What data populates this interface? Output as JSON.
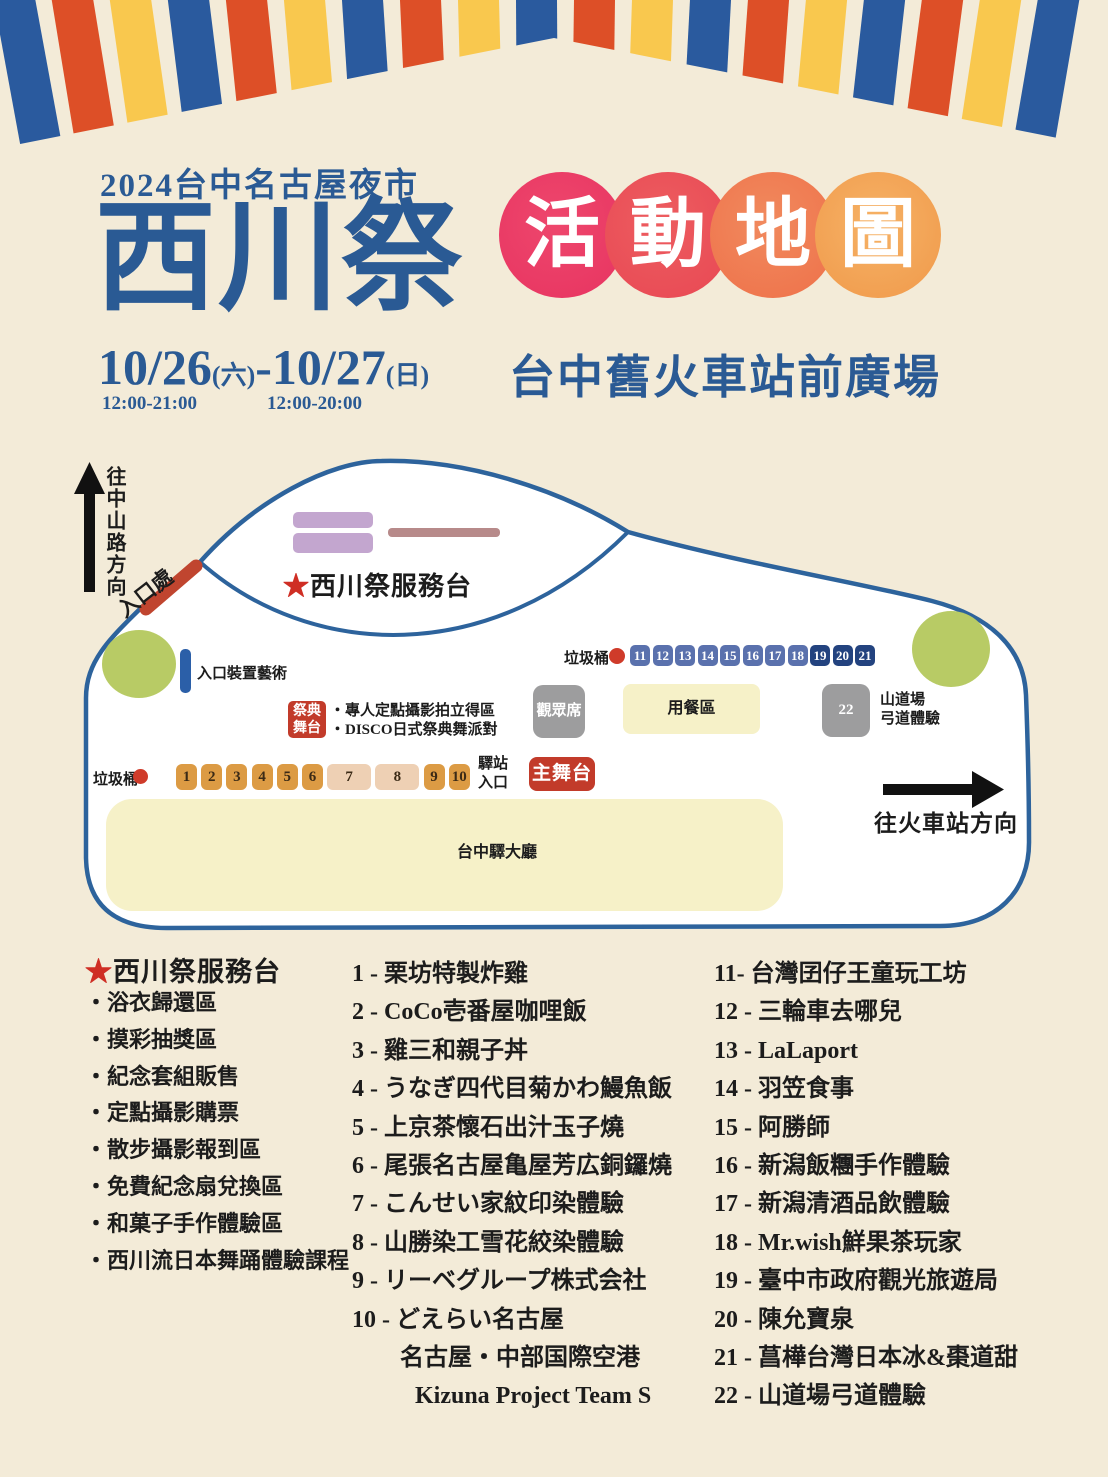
{
  "colors": {
    "background": "#f3ebd8",
    "title_blue": "#2a5a94",
    "stripe_blue": "#2a5a9e",
    "stripe_orange": "#dd4f27",
    "stripe_yellow": "#f9c84e",
    "circle_gradient": [
      "#e73360",
      "#e84753",
      "#ee7049",
      "#f0994a"
    ],
    "map_outline": "#2d639c",
    "accent_red": "#c23b2a",
    "entrance_red": "#c0452f",
    "booth_orange": "#dc9b44",
    "booth_tan": "#eed0b4",
    "booth_blue": "#5a71ad",
    "booth_navy": "#23437f",
    "area_gray": "#9d9d9e",
    "area_yellow": "#f6f1c8",
    "green_area": "#b8cb65",
    "purple_area": "#c3a6cf",
    "mauve_area": "#b78a8a",
    "art_bar_blue": "#2b5fa8"
  },
  "header": {
    "subtitle": "2024台中名古屋夜市",
    "title": "西川祭",
    "map_title_chars": [
      "活",
      "動",
      "地",
      "圖"
    ],
    "venue": "台中舊火車站前廣場",
    "date1": "10/26",
    "day1": "(六)",
    "separator": "-",
    "date2": "10/27",
    "day2": "(日)",
    "time1": "12:00-21:00",
    "time2": "12:00-20:00"
  },
  "map": {
    "to_zhongshan": "往中山路方向",
    "entrance": "入口處",
    "service_desk_star": "★",
    "service_desk": "西川祭服務台",
    "entrance_art": "入口裝置藝術",
    "trash_top": "垃圾桶",
    "trash_bottom": "垃圾桶",
    "audience": "觀眾席",
    "dining": "用餐區",
    "booth22": "22",
    "archery_line1": "山道場",
    "archery_line2": "弓道體驗",
    "festival_stage_line1": "祭典",
    "festival_stage_line2": "舞台",
    "festival_note1": "・專人定點攝影拍立得區",
    "festival_note2": "・DISCO日式祭典舞派對",
    "station_entrance_line1": "驛站",
    "station_entrance_line2": "入口",
    "main_stage": "主舞台",
    "hall": "台中驛大廳",
    "to_station": "往火車站方向",
    "booths_top": [
      {
        "n": "11",
        "c": "blue"
      },
      {
        "n": "12",
        "c": "blue"
      },
      {
        "n": "13",
        "c": "blue"
      },
      {
        "n": "14",
        "c": "blue"
      },
      {
        "n": "15",
        "c": "blue"
      },
      {
        "n": "16",
        "c": "blue"
      },
      {
        "n": "17",
        "c": "blue"
      },
      {
        "n": "18",
        "c": "blue"
      },
      {
        "n": "19",
        "c": "navy"
      },
      {
        "n": "20",
        "c": "navy"
      },
      {
        "n": "21",
        "c": "navy"
      }
    ],
    "booths_bottom": [
      {
        "n": "1",
        "c": "orange"
      },
      {
        "n": "2",
        "c": "orange"
      },
      {
        "n": "3",
        "c": "orange"
      },
      {
        "n": "4",
        "c": "orange"
      },
      {
        "n": "5",
        "c": "orange"
      },
      {
        "n": "6",
        "c": "orange"
      },
      {
        "n": "7",
        "c": "tan",
        "wide": true
      },
      {
        "n": "8",
        "c": "tan",
        "wide": true
      },
      {
        "n": "9",
        "c": "orange"
      },
      {
        "n": "10",
        "c": "orange"
      }
    ]
  },
  "legend": {
    "col1": {
      "star": "★",
      "header": "西川祭服務台",
      "items": [
        "・浴衣歸還區",
        "・摸彩抽獎區",
        "・紀念套組販售",
        "・定點攝影購票",
        "・散步攝影報到區",
        "・免費紀念扇兌換區",
        "・和菓子手作體驗區",
        "・西川流日本舞踊體驗課程"
      ]
    },
    "col2": {
      "items": [
        "1 - 栗坊特製炸雞",
        "2 - CoCo壱番屋咖哩飯",
        "3 - 雞三和親子丼",
        "4 - うなぎ四代目菊かわ鰻魚飯",
        "5 - 上京茶懷石出汁玉子燒",
        "6 - 尾張名古屋亀屋芳広銅鑼燒",
        "7 - こんせい家紋印染體驗",
        "8 - 山勝染工雪花絞染體驗",
        "9 - リーベグループ株式会社",
        "10 - どえらい名古屋"
      ],
      "extra1": "名古屋・中部国際空港",
      "extra2": "Kizuna Project Team S"
    },
    "col3": {
      "items": [
        "11- 台灣囝仔王童玩工坊",
        "12 - 三輪車去哪兒",
        "13 - LaLaport",
        "14 - 羽笠食事",
        "15 - 阿勝師",
        "16 - 新潟飯糰手作體驗",
        "17 - 新潟清酒品飲體驗",
        "18 - Mr.wish鮮果茶玩家",
        "19 - 臺中市政府觀光旅遊局",
        "20 - 陳允寶泉",
        "21 - 菖樺台灣日本冰&棗道甜",
        "22 - 山道場弓道體驗"
      ]
    }
  }
}
